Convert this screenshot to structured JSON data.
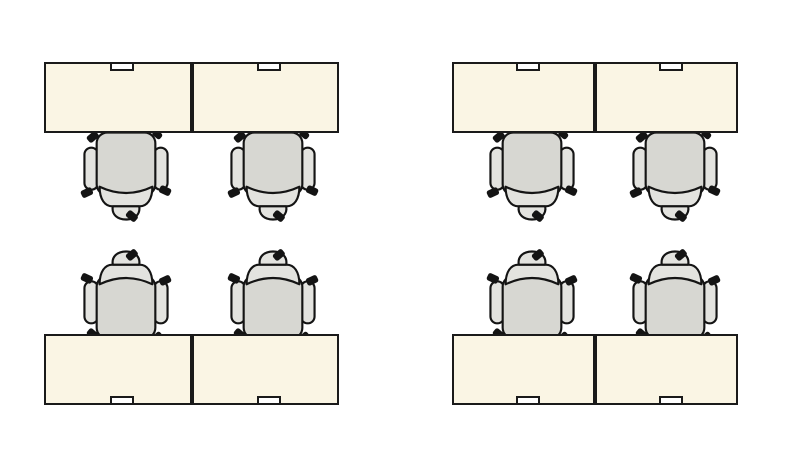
{
  "canvas": {
    "width": 789,
    "height": 459,
    "background": "#ffffff"
  },
  "palette": {
    "desk_fill": "#faf5e4",
    "desk_border": "#1a1a1a",
    "chair_seat_fill": "#d7d7d2",
    "chair_trim_fill": "#e3e3df",
    "chair_outline": "#141414",
    "caster_fill": "#141414",
    "grommet_fill": "#ffffff",
    "grommet_border": "#1a1a1a"
  },
  "chair": {
    "width": 88,
    "height": 90,
    "offset_from_desk_center": 8,
    "tuck_overlap_below": 2,
    "tuck_overlap_above": 6
  },
  "grommet": {
    "width": 24,
    "height": 9,
    "offset_x": 4
  },
  "clusters": [
    {
      "id": "top-left",
      "desk_row": {
        "x": 44,
        "y": 62,
        "width": 295,
        "height": 71
      },
      "desks": 2,
      "chairs": 2,
      "chair_side": "below"
    },
    {
      "id": "top-right",
      "desk_row": {
        "x": 452,
        "y": 62,
        "width": 286,
        "height": 71
      },
      "desks": 2,
      "chairs": 2,
      "chair_side": "below"
    },
    {
      "id": "bottom-left",
      "desk_row": {
        "x": 44,
        "y": 334,
        "width": 295,
        "height": 71
      },
      "desks": 2,
      "chairs": 2,
      "chair_side": "above"
    },
    {
      "id": "bottom-right",
      "desk_row": {
        "x": 452,
        "y": 334,
        "width": 286,
        "height": 71
      },
      "desks": 2,
      "chairs": 2,
      "chair_side": "above"
    }
  ]
}
